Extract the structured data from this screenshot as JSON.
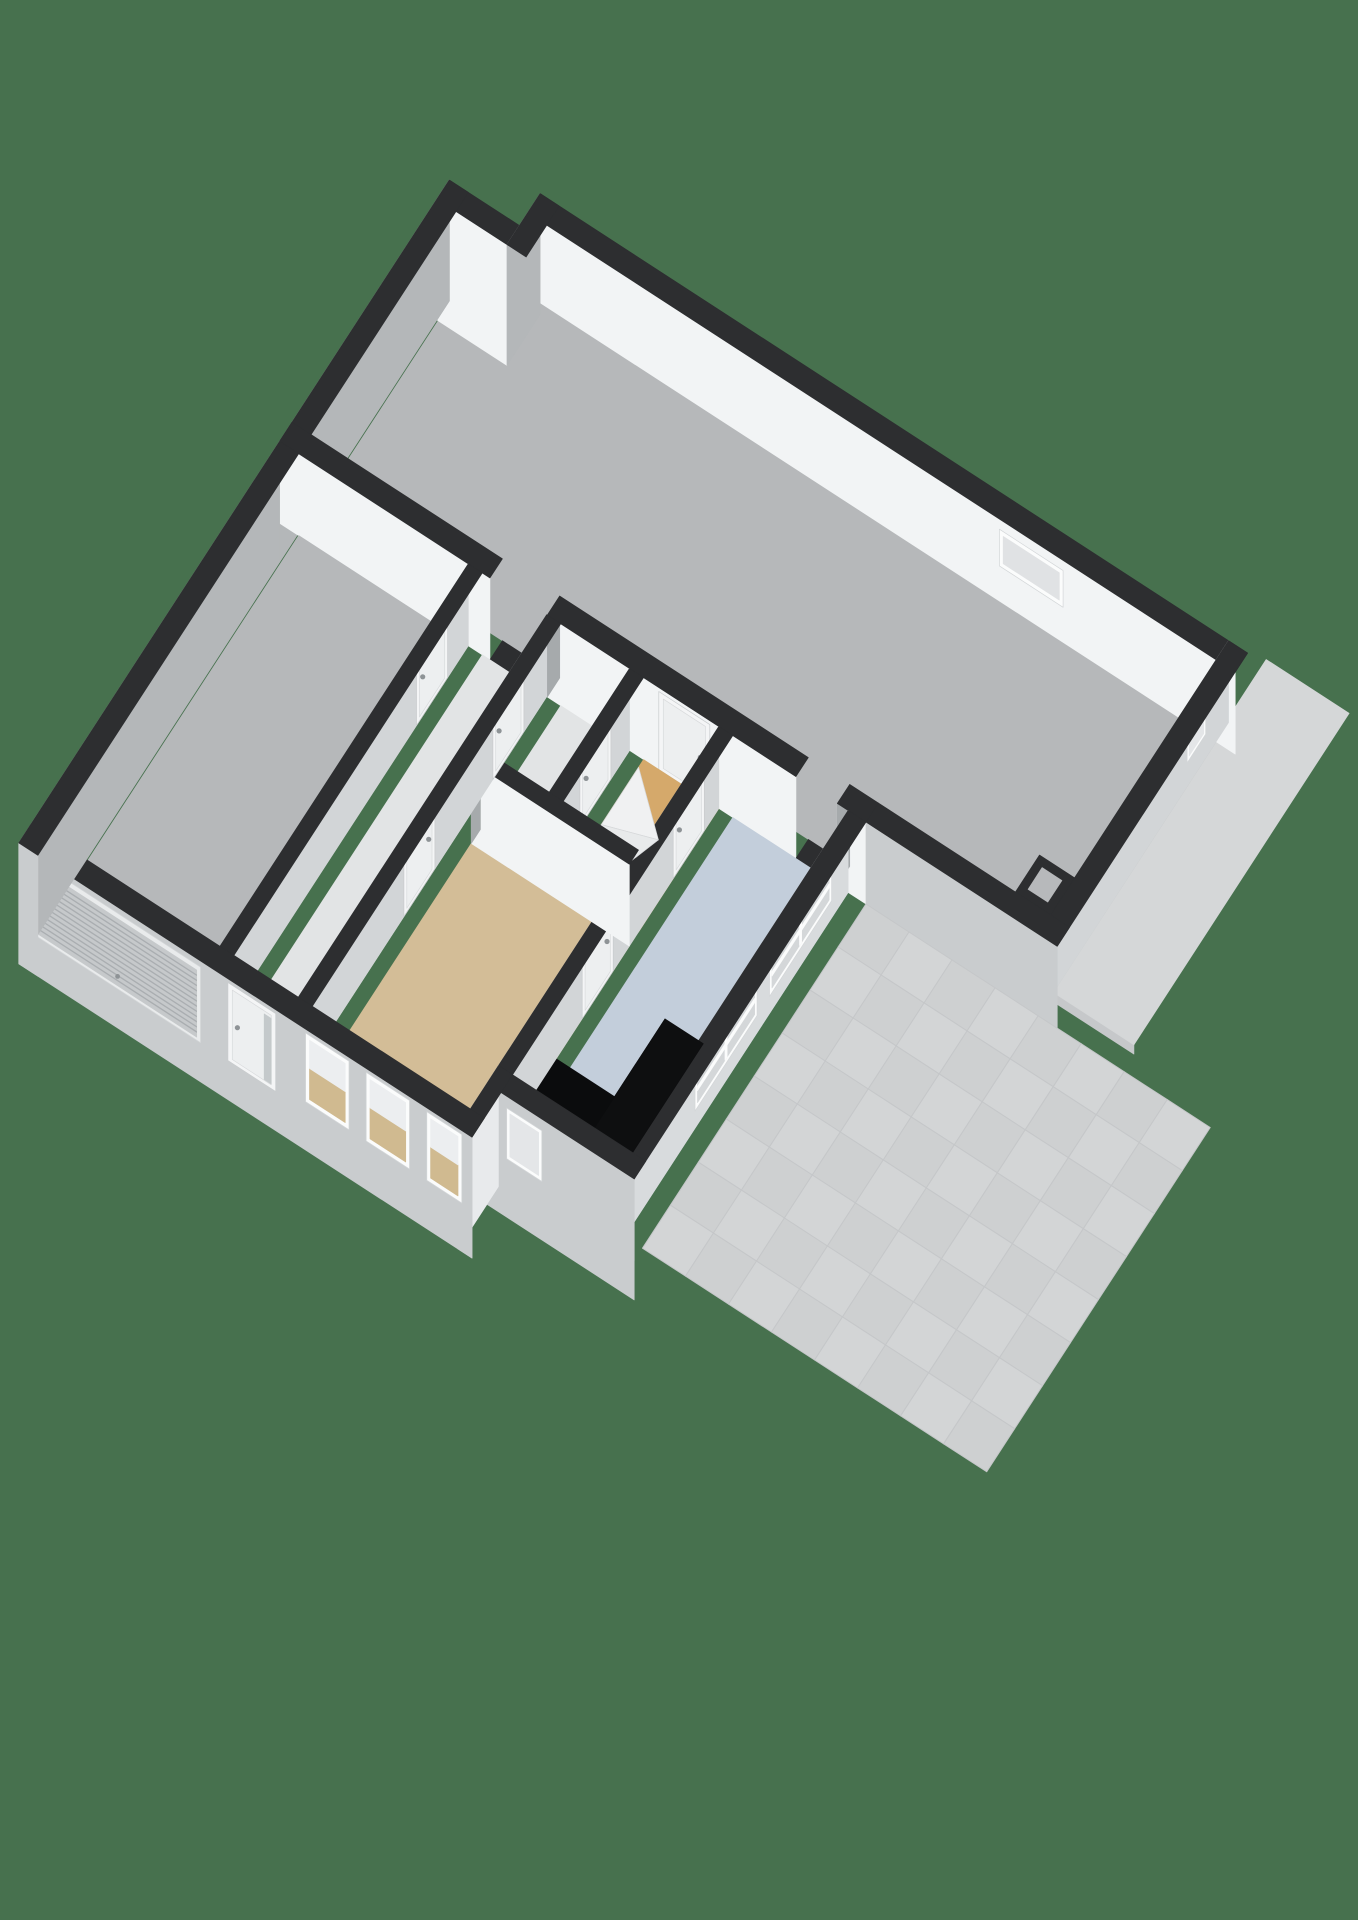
{
  "meta": {
    "title": "3D floor plan view",
    "description": "Isometric 3D cutaway floor plan of a ground floor with storage hall, garage, corridor, bathroom, stair hall, bedroom, kitchen with counter, and tiled terrace, rendered on a green background",
    "view": "3d-floorplan"
  },
  "palette": {
    "background": "#47714e",
    "wall_top": "#2d2e30",
    "exterior_south_face": "#c9ccce",
    "exterior_west_face": "#b4b7b9",
    "interior_bright_face": "#f2f4f5",
    "interior_shaded_face": "#d2d5d7",
    "jamb_cap": "#a6aaac",
    "floor_gray": "#b6b8ba",
    "floor_light": "#e2e4e5",
    "floor_ochre": "#d5a96b",
    "floor_tan": "#d3bd97",
    "floor_blue": "#c3cedb",
    "tile_a": "#d3d5d6",
    "tile_b": "#ced0d1",
    "tile_line": "#c5c7c9",
    "counter_black": "#0e0f10",
    "window_frame": "#fbfcfc",
    "glass_gray": "#d4d7d9",
    "glass_tan": "#d0ba90",
    "door_panel": "#f4f5f6",
    "handle_metal": "#8e9396",
    "canopy_top": "#d5d7d8",
    "canopy_edge": "#c6c8ca",
    "step_a": "#f0f1f2",
    "step_b": "#e8eaeb"
  },
  "rooms": [
    {
      "id": "storage-hall",
      "floor_color": "#b6b8ba",
      "features": [
        "small-window-north",
        "corner-shaft",
        "wall-niche"
      ]
    },
    {
      "id": "garage",
      "floor_color": "#b6b8ba",
      "features": [
        "slatted-garage-door-west",
        "side-door"
      ]
    },
    {
      "id": "entry-corridor",
      "floor_color": "#e2e4e5",
      "features": [
        "front-door-south",
        "open-passage-to-hall"
      ]
    },
    {
      "id": "bathroom",
      "floor_color": "#e2e4e5",
      "features": [
        "door"
      ]
    },
    {
      "id": "stair-hall",
      "floor_color": "#d5a96b",
      "features": [
        "winder-stairs",
        "door-to-hall",
        "door-to-kitchen"
      ]
    },
    {
      "id": "bedroom",
      "floor_color": "#d3bd97",
      "features": [
        "three-south-windows",
        "door-to-corridor",
        "door-to-kitchen"
      ]
    },
    {
      "id": "kitchen",
      "floor_color": "#c3cedb",
      "features": [
        "black-l-counter",
        "two-east-windows",
        "small-south-window",
        "open-passage-to-hall"
      ]
    },
    {
      "id": "terrace",
      "floor_color": "#d3d5d6",
      "features": [
        "tile-grid-8x8"
      ]
    },
    {
      "id": "canopy-roof",
      "floor_color": "#d5d7d8",
      "features": []
    }
  ],
  "scene": {
    "projection": {
      "theta_deg": 33,
      "scale": 76,
      "height_scale": 78,
      "origin_x": 470,
      "origin_y": 230,
      "wall_height": 1.05
    },
    "layers": [
      {
        "t": "slab",
        "name": "canopy-roof",
        "x1": 12.2,
        "y1": -0.45,
        "x2": 13.5,
        "y2": 4.75,
        "z": 0.6,
        "top": "#d5d7d8",
        "edge_s": "#c6c8ca",
        "skirt": 0.12
      },
      {
        "t": "floor",
        "name": "floor-storage-hall",
        "color": "#b6b8ba",
        "pts": [
          [
            0.3,
            0.8
          ],
          [
            1.24,
            0.8
          ],
          [
            1.24,
            0.3
          ],
          [
            11.9,
            0.3
          ],
          [
            11.9,
            4.3
          ],
          [
            0.3,
            4.3
          ]
        ]
      },
      {
        "t": "wall",
        "name": "wall-hall-north",
        "axis": "x",
        "c": 0.15,
        "th": 0.3,
        "from": 1.1,
        "to": 12.2,
        "faceS": "#f2f4f5",
        "top": "#2d2e30",
        "overlays": [
          {
            "kind": "window",
            "from": 8.5,
            "to": 9.5,
            "z0": 0.45,
            "z1": 0.92,
            "glass": "#e0e2e4"
          }
        ]
      },
      {
        "t": "wall",
        "name": "wall-hall-nw-step",
        "axis": "x",
        "c": 0.65,
        "th": 0.3,
        "from": 0.0,
        "to": 1.1,
        "z0": -0.5,
        "faceS": "#f2f4f5",
        "capW": "#a6aaac",
        "top": "#2d2e30"
      },
      {
        "t": "wall",
        "name": "wall-hall-nw-corner",
        "axis": "y",
        "c": 1.25,
        "th": 0.3,
        "from": 0.0,
        "to": 0.8,
        "z0": -0.5,
        "faceW": "#b4b7b9",
        "top": "#2d2e30"
      },
      {
        "t": "wall",
        "name": "wall-hall-west",
        "axis": "y",
        "c": 0.15,
        "th": 0.3,
        "from": 0.5,
        "to": 4.6,
        "z0": -0.5,
        "faceW": "#b4b7b9",
        "top": "#2d2e30"
      },
      {
        "t": "wall",
        "name": "wall-hall-east",
        "axis": "y",
        "c": 12.05,
        "th": 0.3,
        "from": 0.0,
        "to": 4.6,
        "faceW": "#d2d5d7",
        "capS": "#c9ccce",
        "top": "#2d2e30",
        "overlays": [
          {
            "kind": "niche",
            "from": 0.55,
            "to": 1.0,
            "z0": 0.3,
            "z1": 0.8
          }
        ]
      },
      {
        "t": "shaft",
        "name": "hall-corner-shaft",
        "x1": 11.35,
        "y1": 3.72,
        "x2": 11.9,
        "y2": 4.3,
        "faceW": "#eef0f1",
        "faceS": "#f6f7f8",
        "top": "#2d2e30",
        "hole": "#b7b9bb"
      },
      {
        "t": "wall",
        "name": "wall-hall-south-a",
        "axis": "x",
        "c": 4.45,
        "th": 0.3,
        "from": 0.0,
        "to": 3.3,
        "faceS": "#f2f4f5",
        "top": "#2d2e30"
      },
      {
        "t": "poly",
        "name": "passage-threshold-corridor",
        "color": "#2d2e30",
        "pts": [
          [
            3.3,
            4.3
          ],
          [
            4.2,
            4.3
          ],
          [
            4.2,
            4.6
          ],
          [
            3.3,
            4.6
          ]
        ]
      },
      {
        "t": "wall",
        "name": "wall-hall-south-b",
        "axis": "x",
        "c": 4.45,
        "th": 0.3,
        "from": 4.2,
        "to": 8.1,
        "faceS": "#f2f4f5",
        "capW": "#a6aaac",
        "top": "#2d2e30",
        "overlays": [
          {
            "kind": "door",
            "from": 5.95,
            "to": 6.75,
            "handle": "right"
          }
        ]
      },
      {
        "t": "poly",
        "name": "passage-threshold-kitchen",
        "color": "#2d2e30",
        "pts": [
          [
            8.1,
            4.3
          ],
          [
            8.75,
            4.3
          ],
          [
            8.75,
            4.6
          ],
          [
            8.1,
            4.6
          ]
        ]
      },
      {
        "t": "wall",
        "name": "wall-hall-south-c",
        "axis": "x",
        "c": 4.45,
        "th": 0.3,
        "from": 8.75,
        "to": 9.2,
        "faceS": "#f2f4f5",
        "capW": "#a6aaac",
        "top": "#2d2e30"
      },
      {
        "t": "wall",
        "name": "wall-hall-south-terrace",
        "axis": "x",
        "c": 4.45,
        "th": 0.3,
        "from": 9.2,
        "to": 12.2,
        "faceS": "#c9ccce",
        "top": "#2d2e30"
      },
      {
        "t": "tiles",
        "name": "terrace-tiles",
        "x1": 9.2,
        "y1": 4.6,
        "x2": 14.6,
        "y2": 10.0,
        "cols": 8,
        "rows": 8,
        "a": "#d3d5d6",
        "b": "#ced0d1",
        "line": "#c5c7c9"
      },
      {
        "t": "floor",
        "name": "floor-garage",
        "color": "#b6b8ba",
        "pts": [
          [
            0.3,
            4.6
          ],
          [
            2.96,
            4.6
          ],
          [
            2.96,
            10.6
          ],
          [
            0.3,
            10.6
          ]
        ]
      },
      {
        "t": "floor",
        "name": "floor-corridor",
        "color": "#e2e4e5",
        "pts": [
          [
            3.18,
            4.6
          ],
          [
            4.19,
            4.6
          ],
          [
            4.19,
            10.6
          ],
          [
            3.18,
            10.6
          ]
        ]
      },
      {
        "t": "floor",
        "name": "floor-bathroom",
        "color": "#e2e4e5",
        "pts": [
          [
            4.41,
            4.6
          ],
          [
            5.49,
            4.6
          ],
          [
            5.49,
            6.54
          ],
          [
            4.41,
            6.54
          ]
        ]
      },
      {
        "t": "floor",
        "name": "floor-stair-hall",
        "color": "#d5a96b",
        "pts": [
          [
            5.71,
            4.6
          ],
          [
            6.89,
            4.6
          ],
          [
            6.89,
            6.54
          ],
          [
            5.71,
            6.54
          ]
        ]
      },
      {
        "t": "floor",
        "name": "floor-bedroom",
        "color": "#d3bd97",
        "pts": [
          [
            4.41,
            6.76
          ],
          [
            6.89,
            6.76
          ],
          [
            6.89,
            10.6
          ],
          [
            4.41,
            10.6
          ]
        ]
      },
      {
        "t": "floor",
        "name": "floor-kitchen",
        "color": "#c3cedb",
        "pts": [
          [
            7.11,
            4.6
          ],
          [
            8.92,
            4.6
          ],
          [
            8.92,
            9.92
          ],
          [
            7.11,
            9.92
          ]
        ]
      },
      {
        "t": "wall",
        "name": "wall-kitchen-east",
        "axis": "y",
        "c": 9.06,
        "th": 0.28,
        "from": 4.6,
        "to": 10.2,
        "faceW": "#d8dbdd",
        "capS": "#c9ccce",
        "top": "#2d2e30",
        "overlays": [
          {
            "kind": "window",
            "from": 5.0,
            "to": 6.5,
            "z0": 0.22,
            "z1": 1.02,
            "glass": "#d4d7d9",
            "mullion": true,
            "rail": 0.3
          },
          {
            "kind": "window",
            "from": 6.8,
            "to": 8.3,
            "z0": 0.22,
            "z1": 1.02,
            "glass": "#d4d7d9",
            "mullion": true,
            "rail": 0.3
          }
        ]
      },
      {
        "t": "box",
        "name": "kitchen-counter-east",
        "x1": 8.32,
        "y1": 8.1,
        "x2": 8.92,
        "y2": 9.92,
        "h": 0.92,
        "top": "#0e0f10",
        "faceW": "#1b1d1e",
        "faceS": "#060707"
      },
      {
        "t": "box",
        "name": "kitchen-counter-south",
        "x1": 7.11,
        "y1": 9.32,
        "x2": 8.32,
        "y2": 9.92,
        "h": 0.92,
        "top": "#0b0c0d",
        "faceW": "#eff0f1",
        "faceS": "#0a0b0b"
      },
      {
        "t": "wall",
        "name": "wall-kitchen-west",
        "axis": "y",
        "c": 7.0,
        "th": 0.22,
        "from": 4.6,
        "to": 9.92,
        "faceW": "#d2d5d7",
        "top": "#2d2e30",
        "overlays": [
          {
            "kind": "door",
            "from": 4.95,
            "to": 5.7,
            "handle": "right"
          },
          {
            "kind": "door",
            "from": 7.15,
            "to": 7.9,
            "handle": "left"
          }
        ]
      },
      {
        "t": "poly",
        "name": "stair-step-1",
        "color": "#f0f1f2",
        "stroke": "#d6d8da",
        "pts": [
          [
            5.71,
            4.72
          ],
          [
            6.45,
            5.38
          ],
          [
            5.71,
            5.62
          ]
        ]
      },
      {
        "t": "poly",
        "name": "stair-step-2",
        "color": "#e8eaeb",
        "stroke": "#d6d8da",
        "pts": [
          [
            5.71,
            5.62
          ],
          [
            6.45,
            5.38
          ],
          [
            6.25,
            5.95
          ],
          [
            5.71,
            5.95
          ]
        ]
      },
      {
        "t": "poly",
        "name": "stair-step-3",
        "color": "#f0f1f2",
        "stroke": "#d6d8da",
        "pts": [
          [
            5.71,
            5.95
          ],
          [
            6.25,
            5.95
          ],
          [
            6.08,
            6.35
          ],
          [
            5.71,
            6.4
          ]
        ]
      },
      {
        "t": "wall",
        "name": "wall-bathroom-east",
        "axis": "y",
        "c": 5.6,
        "th": 0.22,
        "from": 4.6,
        "to": 6.65,
        "faceW": "#d2d5d7",
        "capS": "#f2f3f4",
        "top": "#2d2e30",
        "overlays": [
          {
            "kind": "door",
            "from": 5.05,
            "to": 5.8,
            "handle": "right"
          }
        ]
      },
      {
        "t": "wall",
        "name": "wall-bedroom-north",
        "axis": "x",
        "c": 6.65,
        "th": 0.22,
        "from": 4.41,
        "to": 6.89,
        "faceS": "#f2f4f5",
        "capW": "#a6aaac",
        "top": "#2d2e30"
      },
      {
        "t": "wall",
        "name": "wall-corridor-east",
        "axis": "y",
        "c": 4.3,
        "th": 0.22,
        "from": 4.6,
        "to": 10.6,
        "faceW": "#d2d5d7",
        "top": "#2d2e30",
        "overlays": [
          {
            "kind": "door",
            "from": 5.15,
            "to": 5.9,
            "handle": "right"
          },
          {
            "kind": "door",
            "from": 7.3,
            "to": 8.05,
            "handle": "left"
          }
        ]
      },
      {
        "t": "wall",
        "name": "wall-garage-east",
        "axis": "y",
        "c": 3.07,
        "th": 0.22,
        "from": 4.6,
        "to": 10.6,
        "faceW": "#d2d5d7",
        "top": "#2d2e30",
        "overlays": [
          {
            "kind": "door",
            "from": 5.1,
            "to": 5.85,
            "handle": "right"
          }
        ]
      },
      {
        "t": "wall",
        "name": "wall-kitchen-south",
        "axis": "x",
        "c": 10.06,
        "th": 0.28,
        "from": 6.89,
        "to": 9.2,
        "z0": -0.5,
        "faceS": "#c9ccce",
        "capW": "#a6aaac",
        "top": "#2d2e30",
        "overlays": [
          {
            "kind": "niche",
            "from": 7.2,
            "to": 7.75,
            "z0": 0.25,
            "z1": 0.9
          }
        ]
      },
      {
        "t": "wall",
        "name": "wall-bedroom-east-jog",
        "axis": "y",
        "c": 7.0,
        "th": 0.22,
        "from": 9.92,
        "to": 10.9,
        "z0": -0.5,
        "faceW": "#e8eaec",
        "capS": "#c9ccce",
        "top": "#2d2e30"
      },
      {
        "t": "wall",
        "name": "wall-south-main",
        "axis": "x",
        "c": 10.75,
        "th": 0.3,
        "from": 0.0,
        "to": 7.11,
        "z0": -0.5,
        "faceS": "#c9ccce",
        "top": "#2d2e30",
        "overlays": [
          {
            "kind": "garage-door",
            "from": 0.25,
            "to": 2.85
          },
          {
            "kind": "door",
            "from": 3.28,
            "to": 4.03,
            "handle": "left",
            "sidelight": true
          },
          {
            "kind": "window",
            "from": 4.5,
            "to": 5.18,
            "z0": 0.12,
            "z1": 1.0,
            "split": true
          },
          {
            "kind": "window",
            "from": 5.45,
            "to": 6.13,
            "z0": 0.12,
            "z1": 1.0,
            "split": true
          },
          {
            "kind": "window",
            "from": 6.4,
            "to": 6.95,
            "z0": 0.12,
            "z1": 1.0,
            "split": true
          }
        ]
      },
      {
        "t": "wall",
        "name": "wall-west-main",
        "axis": "y",
        "c": 0.15,
        "th": 0.3,
        "from": 4.6,
        "to": 10.9,
        "z0": -0.5,
        "faceW": "#b4b7b9",
        "capS": "#c9ccce",
        "top": "#2d2e30"
      }
    ]
  }
}
